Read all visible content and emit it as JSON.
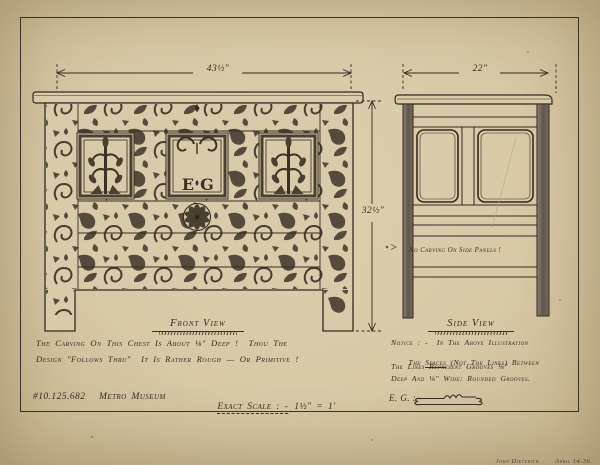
{
  "sheet": {
    "colors": {
      "paper": "#d7c8a6",
      "ink": "#332b20",
      "carving": "#4a4032"
    },
    "front": {
      "view_label": "Front View",
      "width_dim": "43½″",
      "height_dim": "32½″",
      "initial_left": "E",
      "initial_right": "G",
      "caption_line1": "The Carving On This Chest Is About ⅛″ Deep !  Thou The",
      "caption_line2": "Design \"Follows Thru\"  It Is Rather Rough — Or Primitive !"
    },
    "side": {
      "view_label": "Side View",
      "width_dim": "22″",
      "panel_note": "No Carving On Side Panels !",
      "notice_line1": "Notice : -  In The Above Illustration",
      "notice_line2_pre": "The ",
      "notice_line2_underlined": "Spaces",
      "notice_line2_post": " (Not The Lines) Between",
      "notice_line3": "The Lines Represent Grooves ⅛″",
      "notice_line4": "Deep And ⅛″ Wide: Rounded Grooves.",
      "example_label": "E. G. : -"
    },
    "footer": {
      "accession": "#10.125.682",
      "museum": "Metro Museum",
      "scale_label": "Exact Scale : -",
      "scale_value": "1½″ = 1′"
    },
    "signature": {
      "artist": "John Dieterich",
      "date": "April 14-36."
    }
  }
}
